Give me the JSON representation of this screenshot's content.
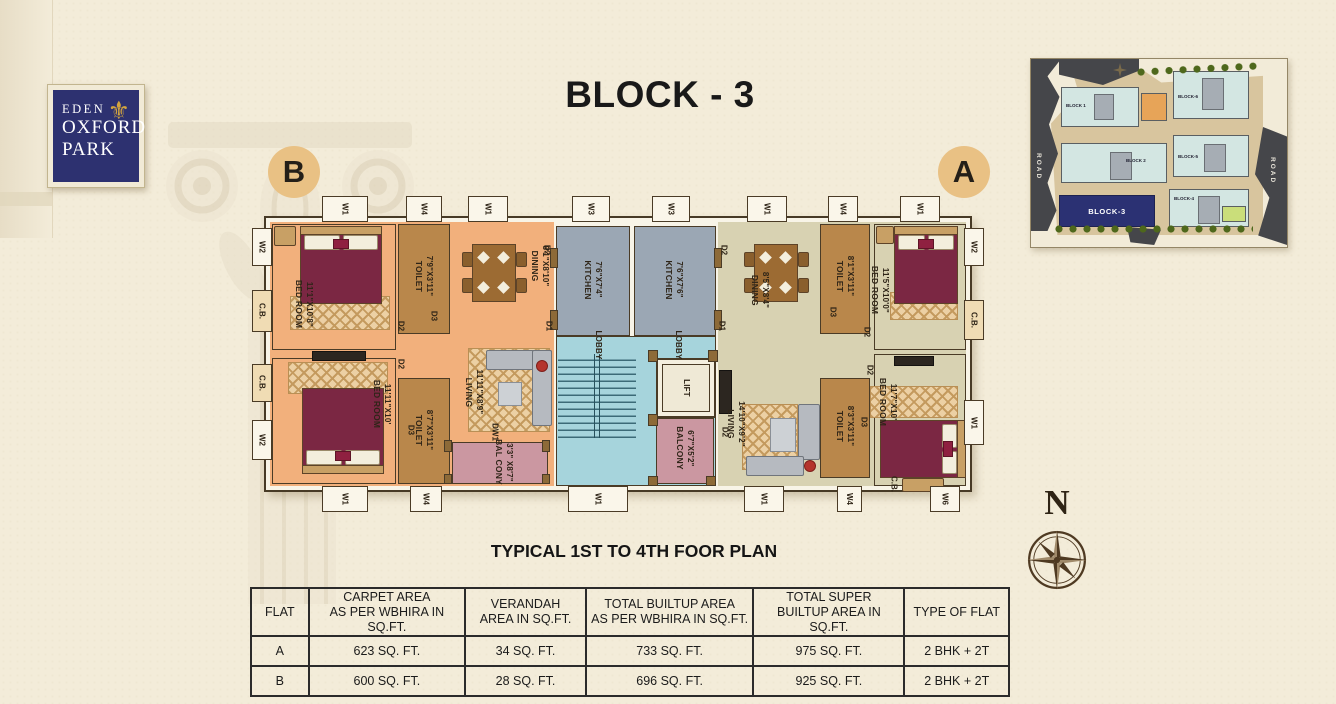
{
  "logo": {
    "line1": "EDEN",
    "line2": "OXFORD",
    "line3": "PARK",
    "fleur_icon": "fleur-de-lis"
  },
  "title": "BLOCK - 3",
  "subtitle": "TYPICAL 1ST TO 4TH FOOR PLAN",
  "markers": {
    "a": "A",
    "b": "B"
  },
  "compass": {
    "north": "N"
  },
  "plan": {
    "flat_b": {
      "bedroom1": {
        "name": "BED ROOM",
        "dims": "11'1\"X10'8\""
      },
      "toilet1": {
        "name": "TOILET",
        "dims": "7'9\"X3'11\""
      },
      "dining": {
        "name": "DINING",
        "dims": "8'1\"X8'10\""
      },
      "bedroom2": {
        "name": "BED ROOM",
        "dims": "11'11\"X10'"
      },
      "toilet2": {
        "name": "TOILET",
        "dims": "8'7\"X3'11\""
      },
      "living": {
        "name": "LIVING",
        "dims": "11'11\"X8'9\""
      },
      "balcony": {
        "name": "BAL CONY",
        "dims": "3'3\" X8'7\""
      }
    },
    "common": {
      "kitchen_b": {
        "name": "KITCHEN",
        "dims": "7'6\"X7'4\""
      },
      "kitchen_a": {
        "name": "KITCHEN",
        "dims": "7'6\"X7'6\""
      },
      "lobby": "LOBBY",
      "lift": "LIFT",
      "balcony": {
        "name": "BALCONY",
        "dims": "6'7\"X5'2\""
      }
    },
    "flat_a": {
      "dining": {
        "name": "DINING",
        "dims": "8'5\"X8'4\""
      },
      "toilet1": {
        "name": "TOILET",
        "dims": "8'1\"X3'11\""
      },
      "bedroom1": {
        "name": "BED ROOM",
        "dims": "11'5\"X10'0\""
      },
      "living": {
        "name": "LIVING",
        "dims": "14'10\"X9'2\""
      },
      "toilet2": {
        "name": "TOILET",
        "dims": "8'3\"X3'11\""
      },
      "bedroom2": {
        "name": "BED ROOM",
        "dims": "11'7\"X10'"
      }
    },
    "tags": {
      "w1": "W1",
      "w2": "W2",
      "w3": "W3",
      "w4": "W4",
      "w6": "W6",
      "d1": "D1",
      "d2": "D2",
      "d3": "D3",
      "dw1": "DW1",
      "cb": "C.B."
    }
  },
  "site_map": {
    "blocks": [
      "BLOCK 1",
      "BLOCK 2",
      "BLOCK-3",
      "BLOCK-4",
      "BLOCK-5",
      "BLOCK-6"
    ],
    "highlight": "BLOCK-3",
    "road": "ROAD"
  },
  "table": {
    "headers": [
      {
        "l1": "FLAT",
        "l2": ""
      },
      {
        "l1": "CARPET AREA",
        "l2": "AS PER WBHIRA IN SQ.FT."
      },
      {
        "l1": "VERANDAH",
        "l2": "AREA IN SQ.FT."
      },
      {
        "l1": "TOTAL BUILTUP AREA",
        "l2": "AS PER WBHIRA IN SQ.FT."
      },
      {
        "l1": "TOTAL SUPER",
        "l2": "BUILTUP AREA IN SQ.FT."
      },
      {
        "l1": "TYPE OF FLAT",
        "l2": ""
      }
    ],
    "rows": [
      {
        "flat": "A",
        "carpet": "623 SQ. FT.",
        "verandah": "34 SQ. FT.",
        "builtup": "733 SQ. FT.",
        "super_builtup": "975 SQ. FT.",
        "type": "2 BHK + 2T"
      },
      {
        "flat": "B",
        "carpet": "600 SQ. FT.",
        "verandah": "28 SQ. FT.",
        "builtup": "696 SQ. FT.",
        "super_builtup": "925 SQ. FT.",
        "type": "2 BHK + 2T"
      }
    ]
  },
  "colors": {
    "flat_a_floor": "#d8d2b2",
    "flat_b_floor": "#f2b07c",
    "kitchen": "#9ba7b4",
    "lobby": "#a6d4dc",
    "toilet": "#b9874b",
    "balcony": "#cb97a1",
    "bed": "#7b2743",
    "highlight_block": "#2b3173",
    "marker": "#e9c184",
    "logo_navy": "#2d3170",
    "gold": "#d2a43e"
  }
}
